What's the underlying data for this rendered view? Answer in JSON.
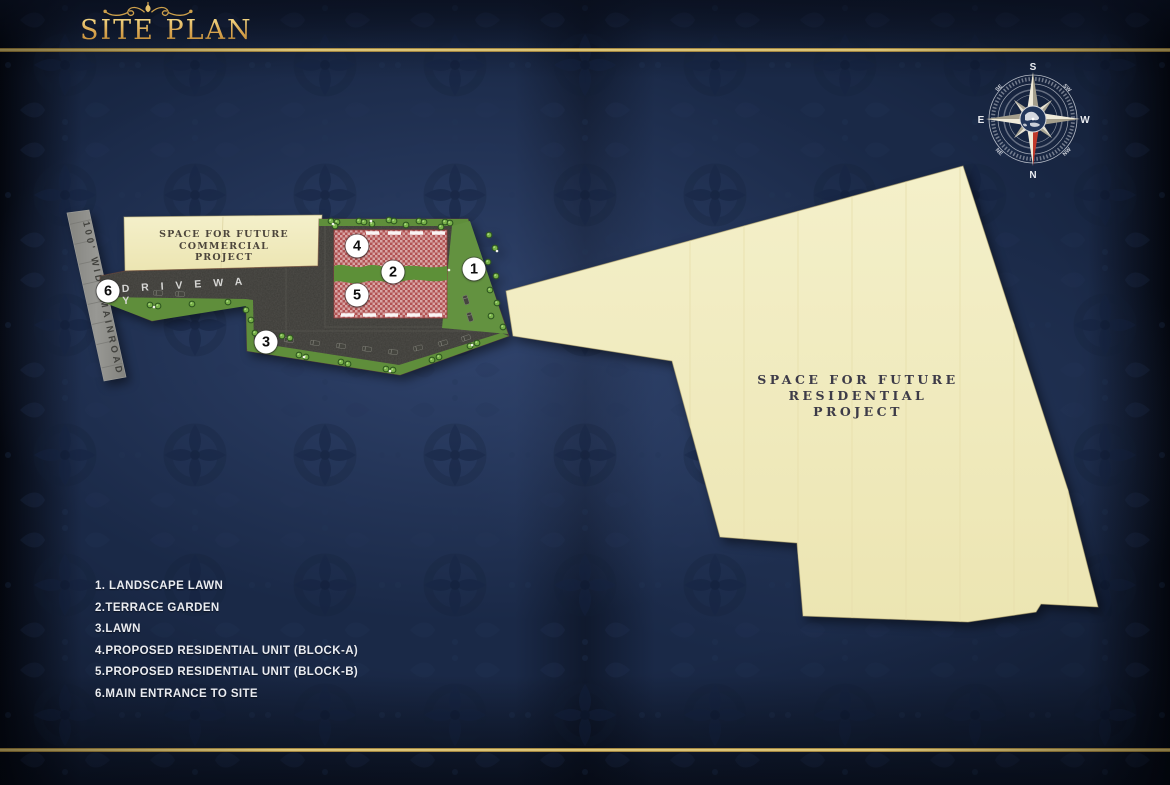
{
  "title": "SITE PLAN",
  "compass": {
    "top": "S",
    "bottom": "N",
    "left": "E",
    "right": "W",
    "top_left": "SE",
    "top_right": "SW",
    "bottom_left": "NE",
    "bottom_right": "NW"
  },
  "map": {
    "mainroad_label": "100' WIDE MAINROAD",
    "driveway_label": "D R I V E   W A Y",
    "commercial_area": {
      "lines": [
        "SPACE FOR FUTURE",
        "COMMERCIAL",
        "PROJECT"
      ]
    },
    "residential_area": {
      "lines": [
        "SPACE FOR FUTURE",
        "RESIDENTIAL",
        "PROJECT"
      ]
    },
    "markers": [
      {
        "num": "1",
        "x": 474,
        "y": 269
      },
      {
        "num": "2",
        "x": 393,
        "y": 272
      },
      {
        "num": "3",
        "x": 266,
        "y": 342
      },
      {
        "num": "4",
        "x": 357,
        "y": 246
      },
      {
        "num": "5",
        "x": 357,
        "y": 295
      },
      {
        "num": "6",
        "x": 108,
        "y": 291
      }
    ]
  },
  "legend": {
    "items": [
      "1. LANDSCAPE LAWN",
      "2.TERRACE GARDEN",
      "3.LAWN",
      "4.PROPOSED RESIDENTIAL UNIT (BLOCK-A)",
      "5.PROPOSED RESIDENTIAL UNIT (BLOCK-B)",
      "6.MAIN ENTRANCE TO SITE"
    ]
  },
  "colors": {
    "background_navy": "#1a2947",
    "gold": "#d9a94f",
    "cream_area": "#f2edc2",
    "asphalt": "#3b3a36",
    "lawn_green": "#5f8e3b",
    "block_red": "#b25252",
    "road_gray": "#8f8f8c",
    "compass_red": "#c0392b"
  }
}
